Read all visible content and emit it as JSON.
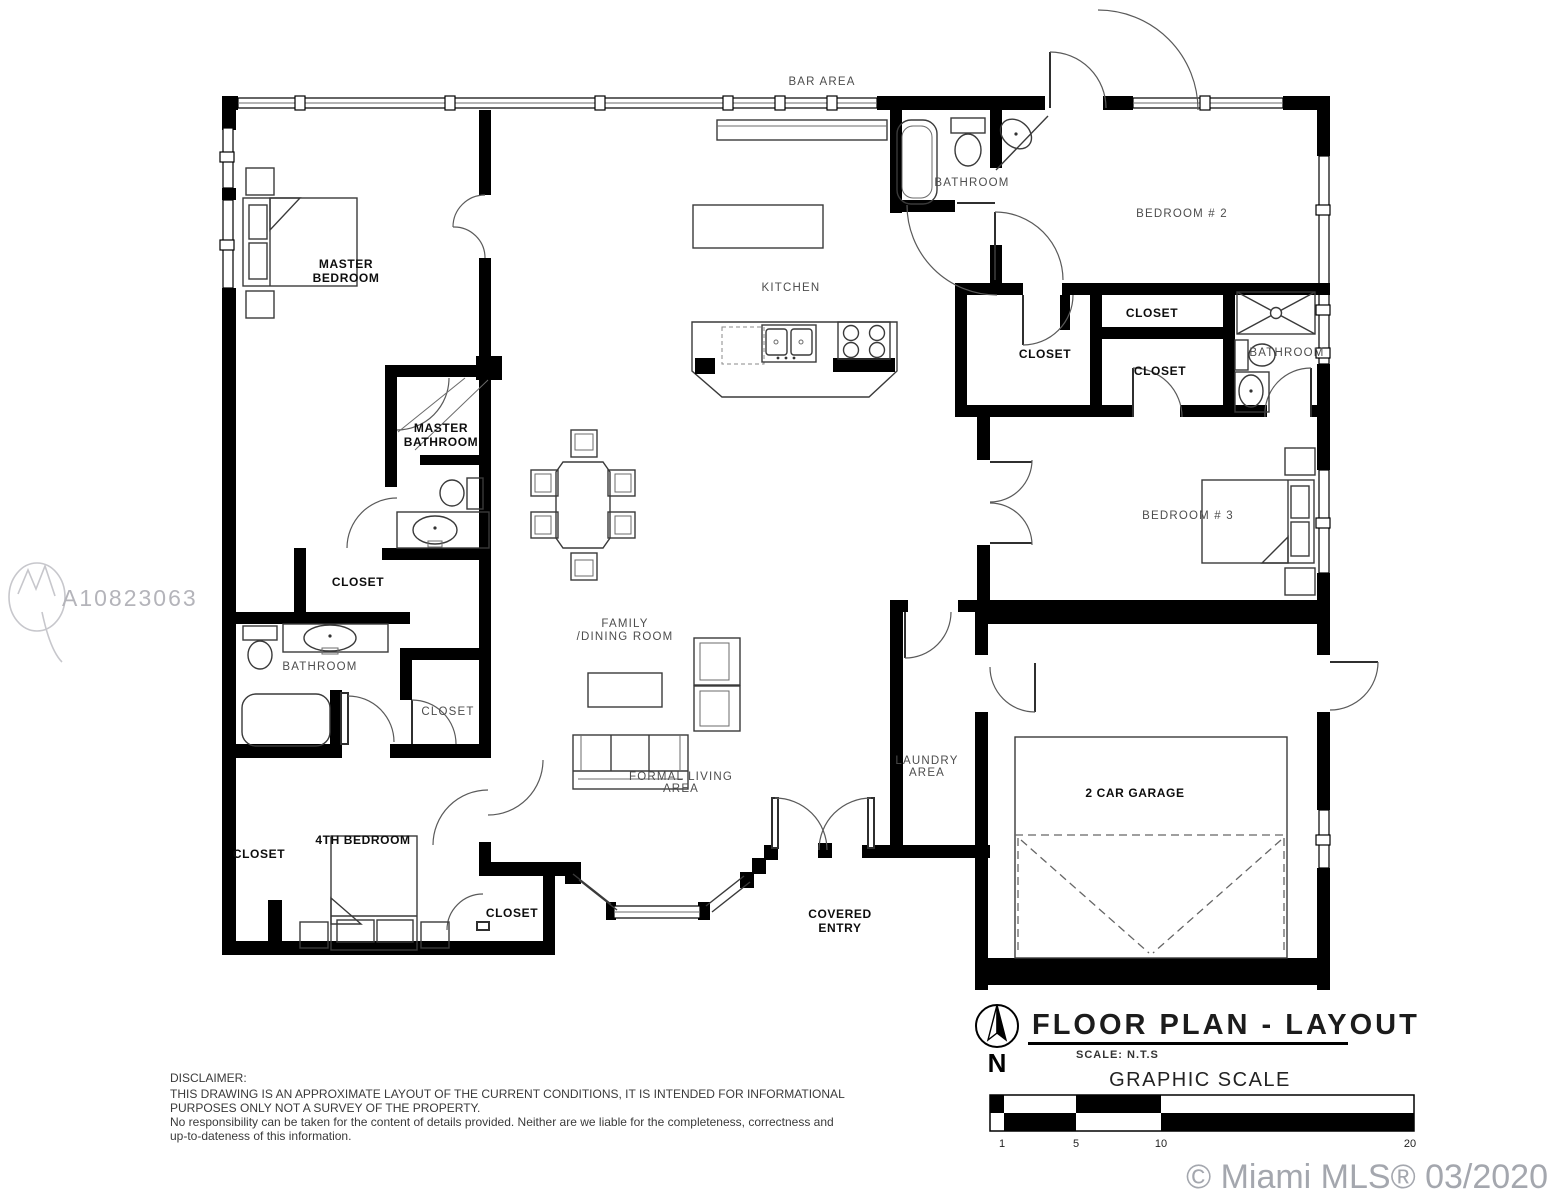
{
  "watermarks": {
    "mls_id": "A10823063",
    "copyright": "© Miami MLS® 03/2020"
  },
  "labels": {
    "bar_area": "BAR AREA",
    "bathroom_top": "BATHROOM",
    "bedroom_2": "BEDROOM # 2",
    "master_bedroom_1": "MASTER",
    "master_bedroom_2": "BEDROOM",
    "kitchen": "KITCHEN",
    "closet_hall_top": "CLOSET",
    "closet_hall_left": "CLOSET",
    "closet_hall_bottom": "CLOSET",
    "bathroom_right": "BATHROOM",
    "master_bathroom_1": "MASTER",
    "master_bathroom_2": "BATHROOM",
    "bedroom_3": "BEDROOM # 3",
    "closet_master": "CLOSET",
    "bathroom_left": "BATHROOM",
    "closet_mid": "CLOSET",
    "family_1": "FAMILY",
    "family_2": "/DINING ROOM",
    "formal_1": "FORMAL LIVING",
    "formal_2": "AREA",
    "laundry_1": "LAUNDRY",
    "laundry_2": "AREA",
    "garage": "2 CAR GARAGE",
    "covered_1": "COVERED",
    "covered_2": "ENTRY",
    "closet_bottom_left": "CLOSET",
    "bedroom_4": "4TH BEDROOM",
    "closet_bottom": "CLOSET"
  },
  "title_block": {
    "title": "FLOOR  PLAN - LAYOUT",
    "scale": "SCALE:  N.T.S",
    "north": "N",
    "graphic_scale_title": "GRAPHIC SCALE",
    "ticks": [
      "1",
      "5",
      "10",
      "20"
    ]
  },
  "disclaimer": {
    "l1": "DISCLAIMER:",
    "l2": "THIS DRAWING IS AN APPROXIMATE LAYOUT OF THE CURRENT CONDITIONS, IT IS INTENDED FOR INFORMATIONAL",
    "l3": "PURPOSES ONLY NOT A SURVEY OF THE PROPERTY.",
    "l4": "No responsibility can be taken for the content of details provided. Neither are we liable for the completeness, correctness and",
    "l5": "up-to-dateness of this information."
  }
}
